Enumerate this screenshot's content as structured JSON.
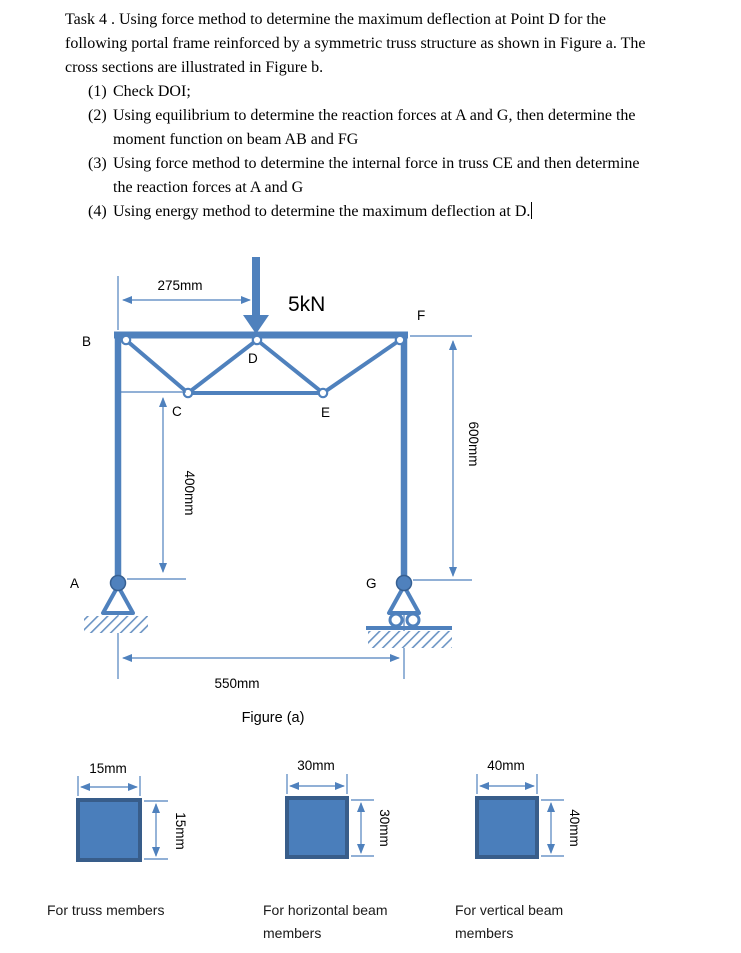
{
  "task": {
    "intro_lines": [
      "Task 4 . Using force method to determine the maximum deflection at Point D for the",
      "following portal frame reinforced by a symmetric truss structure  as shown in Figure a. The",
      "cross sections are illustrated in Figure b."
    ],
    "items": [
      {
        "num": "(1)",
        "lines": [
          "Check DOI;"
        ]
      },
      {
        "num": "(2)",
        "lines": [
          "Using equilibrium to determine the reaction forces at A and G, then determine the",
          "moment function on beam AB and FG"
        ]
      },
      {
        "num": "(3)",
        "lines": [
          "Using force method to determine the internal force in truss CE  and then determine",
          "the reaction forces at A and G"
        ]
      },
      {
        "num": "(4)",
        "lines": [
          "Using energy method to determine the maximum deflection at D."
        ]
      }
    ]
  },
  "figure_a": {
    "caption": "Figure (a)",
    "load_label": "5kN",
    "dims": {
      "span_top": "275mm",
      "height_right": "600mm",
      "height_left": "400mm",
      "span_bottom": "550mm"
    },
    "nodes": {
      "A": "A",
      "B": "B",
      "C": "C",
      "D": "D",
      "E": "E",
      "F": "F",
      "G": "G"
    }
  },
  "figure_b": {
    "sections": [
      {
        "width_label": "15mm",
        "height_label": "15mm",
        "caption_line1": "For truss members",
        "caption_line2": ""
      },
      {
        "width_label": "30mm",
        "height_label": "30mm",
        "caption_line1": "For horizontal beam",
        "caption_line2": "members"
      },
      {
        "width_label": "40mm",
        "height_label": "40mm",
        "caption_line1": "For vertical beam",
        "caption_line2": "members"
      }
    ]
  },
  "colors": {
    "member": "#4f81bd",
    "member_dark": "#385d8a",
    "dim_line": "#4f81bd",
    "section_fill": "#4a7ebb",
    "hatch": "#6b94c4"
  }
}
